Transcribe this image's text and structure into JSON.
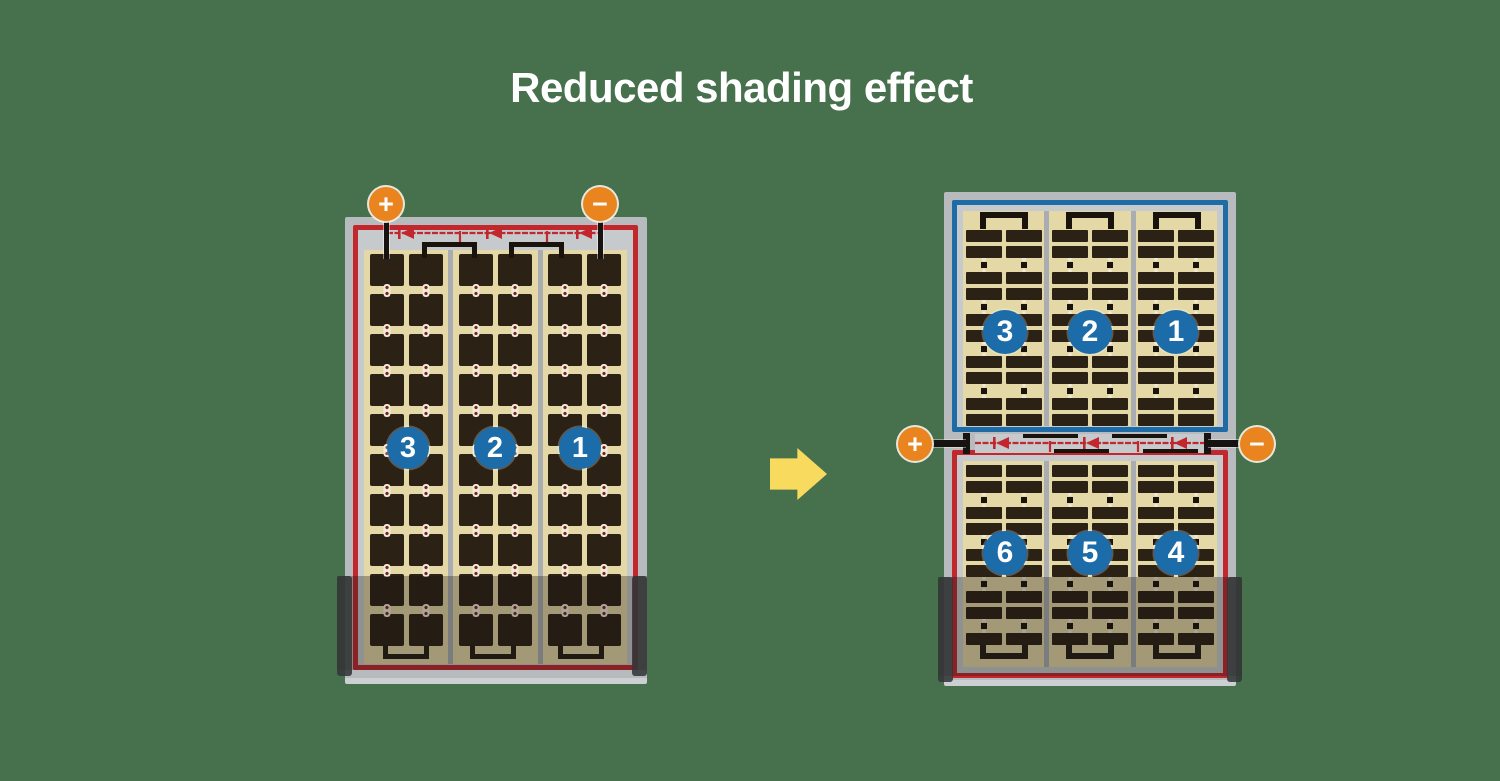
{
  "title": "Reduced shading effect",
  "left_module": {
    "description": "full-cell module with bypass diodes at top",
    "terminals": {
      "plus": "+",
      "minus": "−"
    },
    "string_labels": [
      "3",
      "2",
      "1"
    ],
    "bypass_diodes": 3,
    "grid": {
      "pairs": 3,
      "columns_per_pair": 2,
      "rows": 10,
      "cell_style": "full-square"
    },
    "border_color": "#c1272d"
  },
  "right_module": {
    "description": "split half-cut-cell module with centre bypass diodes",
    "terminals": {
      "plus": "+",
      "minus": "−"
    },
    "bypass_diodes": 3,
    "top_half": {
      "string_labels": [
        "3",
        "2",
        "1"
      ],
      "grid": {
        "pairs": 3,
        "columns_per_pair": 2,
        "rows": 10,
        "cell_style": "half-cut"
      },
      "border_color": "#1e6ba6"
    },
    "bottom_half": {
      "string_labels": [
        "6",
        "5",
        "4"
      ],
      "grid": {
        "pairs": 3,
        "columns_per_pair": 2,
        "rows": 9,
        "cell_style": "half-cut"
      },
      "border_color": "#c1272d"
    }
  },
  "colors": {
    "bg": "#47704d",
    "title_text": "#ffffff",
    "frame": "#b8bbbe",
    "margin": "#c7cacc",
    "divider": "#a9adb2",
    "tan": "#e5d8a7",
    "cell": "#2b2115",
    "busbar": "#1a130c",
    "wire": "#171310",
    "red": "#c1272d",
    "blue": "#1e6ba6",
    "circle": "#1b6ca8",
    "orange": "#e9841f",
    "yellow": "#f8da5e",
    "shade": "rgba(25,22,18,0.32)",
    "cap": "rgba(52,53,56,0.88)"
  }
}
